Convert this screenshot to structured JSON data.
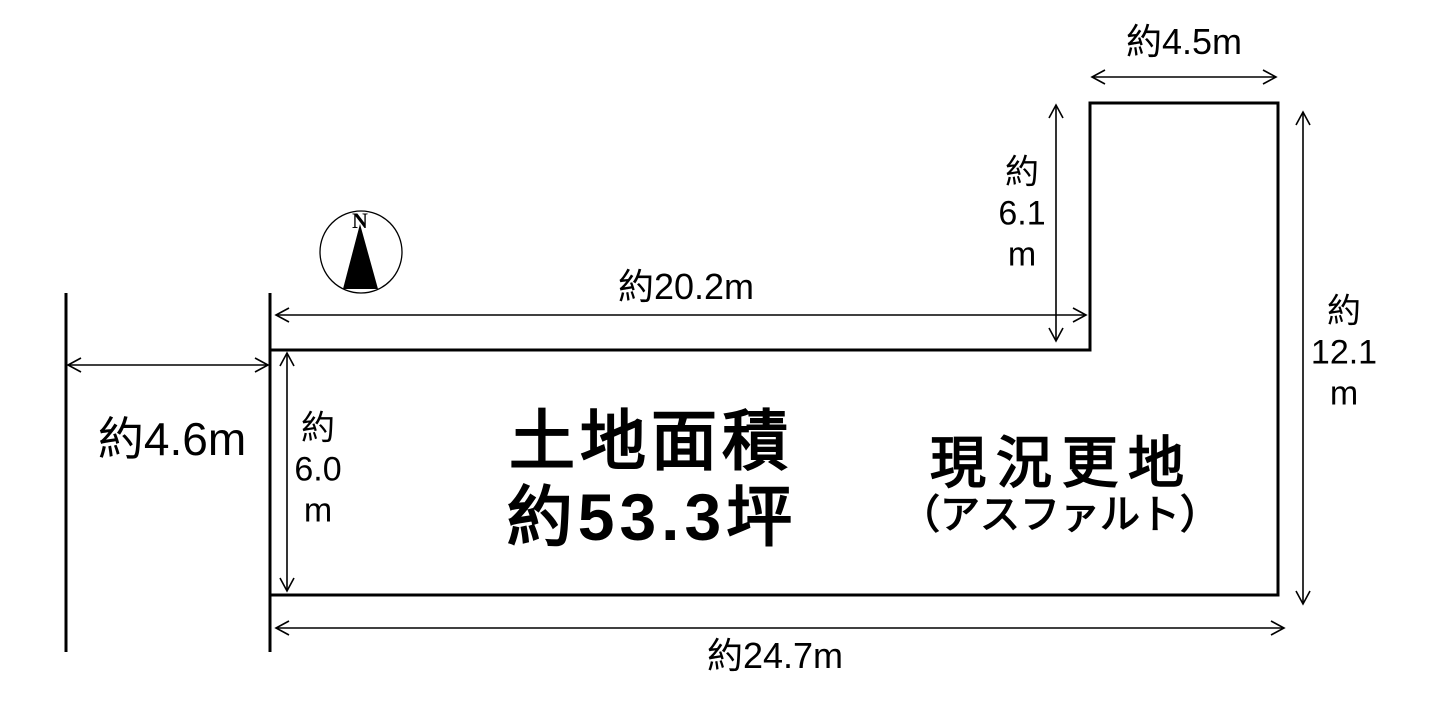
{
  "page": {
    "background": "#ffffff",
    "line_color": "#000000"
  },
  "compass": {
    "north_label": "N"
  },
  "dimensions": {
    "flag_top_width": "約4.5m",
    "flag_height": "約\n6.1\nm",
    "main_top_width": "約20.2m",
    "road_width": "約4.6m",
    "main_left_depth": "約\n6.0\nm",
    "right_depth": "約\n12.1\nm",
    "bottom_width": "約24.7m"
  },
  "area": {
    "title": "土地面積",
    "value": "約53.3坪"
  },
  "status": {
    "line1": "現況更地",
    "line2": "（アスファルト）"
  }
}
